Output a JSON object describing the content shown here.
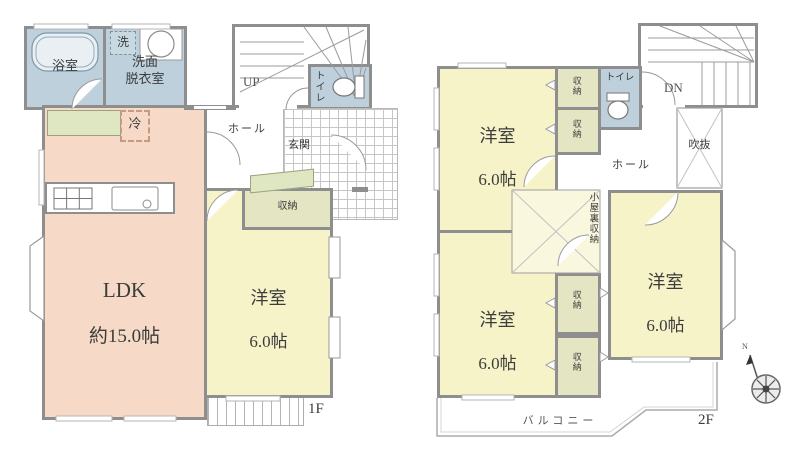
{
  "plan_title": "2-story house floor plan",
  "colors": {
    "wall": "#8e8e8e",
    "wet_room_blue": "#bdd0dc",
    "ldk_salmon": "#f6dac7",
    "bedroom_yellow": "#f6f3c9",
    "closet_olive": "#e3e5c3",
    "cabinet_green": "#dfe7c2",
    "text": "#3c3c3c"
  },
  "f1": {
    "label": "1F",
    "bath": "浴室",
    "laundry": "洗",
    "washroom": "洗面\n脱衣室",
    "stairs": "UP",
    "toilet": "トイレ",
    "hall": "ホール",
    "entrance": "玄関",
    "fridge": "冷",
    "ldk_name": "LDK",
    "ldk_size": "約15.0帖",
    "closet": "収納",
    "room_name": "洋室",
    "room_size": "6.0帖"
  },
  "f2": {
    "label": "2F",
    "stairs": "DN",
    "toilet": "トイレ",
    "closet": "収納",
    "void": "吹抜",
    "hall": "ホール",
    "attic": "小屋裏収納",
    "room_name": "洋室",
    "room_size": "6.0帖",
    "balcony": "バルコニー",
    "compass_north": "N"
  }
}
